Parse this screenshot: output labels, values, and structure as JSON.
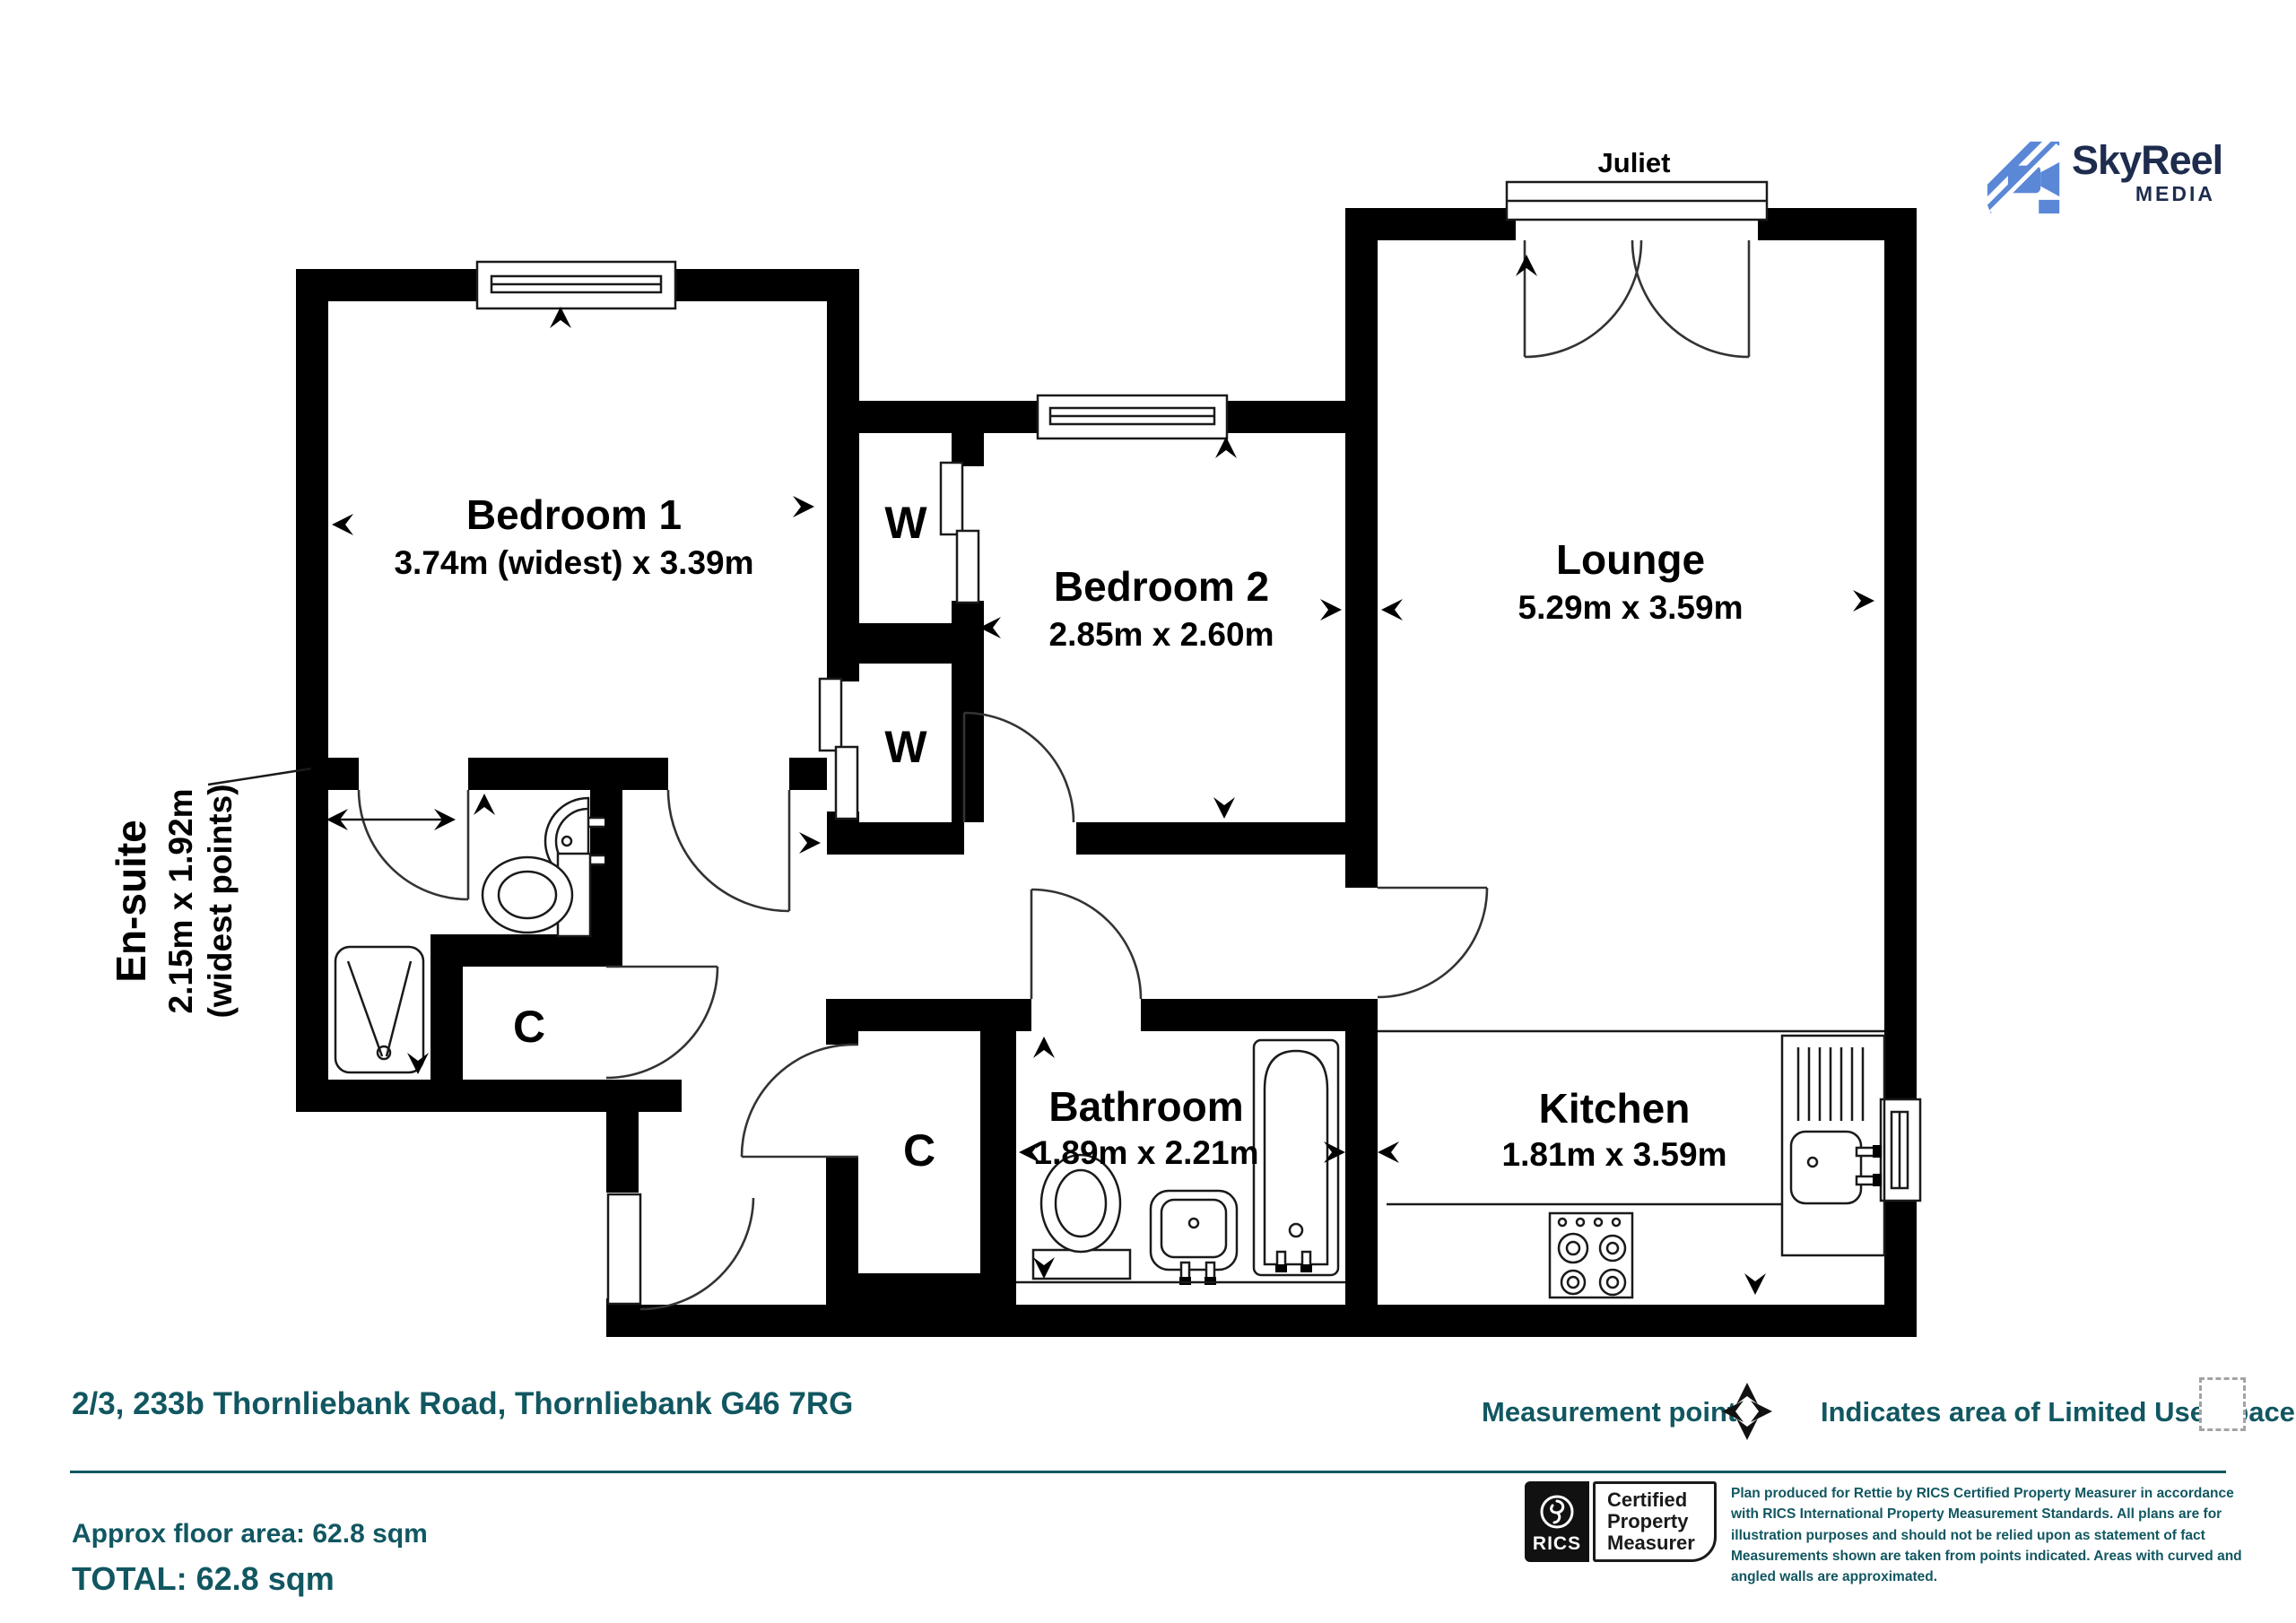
{
  "branding": {
    "name": "SkyReel",
    "media": "MEDIA"
  },
  "plan": {
    "balcony": "Juliet",
    "bedroom1": {
      "name": "Bedroom 1",
      "dims": "3.74m (widest) x 3.39m"
    },
    "bedroom2": {
      "name": "Bedroom 2",
      "dims": "2.85m x 2.60m"
    },
    "lounge": {
      "name": "Lounge",
      "dims": "5.29m x 3.59m"
    },
    "kitchen": {
      "name": "Kitchen",
      "dims": "1.81m x 3.59m"
    },
    "bathroom": {
      "name": "Bathroom",
      "dims": "1.89m x 2.21m"
    },
    "ensuite": {
      "name": "En-suite",
      "dims": "2.15m x 1.92m",
      "note": "(widest points)"
    },
    "wardrobe": "W",
    "cupboard": "C"
  },
  "footer": {
    "address": "2/3, 233b Thornliebank Road, Thornliebank G46 7RG",
    "measurement_point": "Measurement point",
    "limited_use": "Indicates area of Limited Use Space",
    "approx_area": "Approx floor area: 62.8 sqm",
    "total": "TOTAL: 62.8 sqm",
    "rics": {
      "brand": "RICS",
      "lines": [
        "Certified",
        "Property",
        "Measurer"
      ]
    },
    "disclaimer": "Plan produced for Rettie by RICS Certified Property Measurer in accordance with RICS International Property  Measurement Standards.  All plans are for illustration purposes and should not be relied upon as statement of fact Measurements shown are taken from points indicated. Areas with curved and angled walls are approximated."
  },
  "colors": {
    "teal": "#115761",
    "logo_blue": "#5b87d7",
    "logo_navy": "#1e2c4e",
    "wall": "#000000"
  }
}
